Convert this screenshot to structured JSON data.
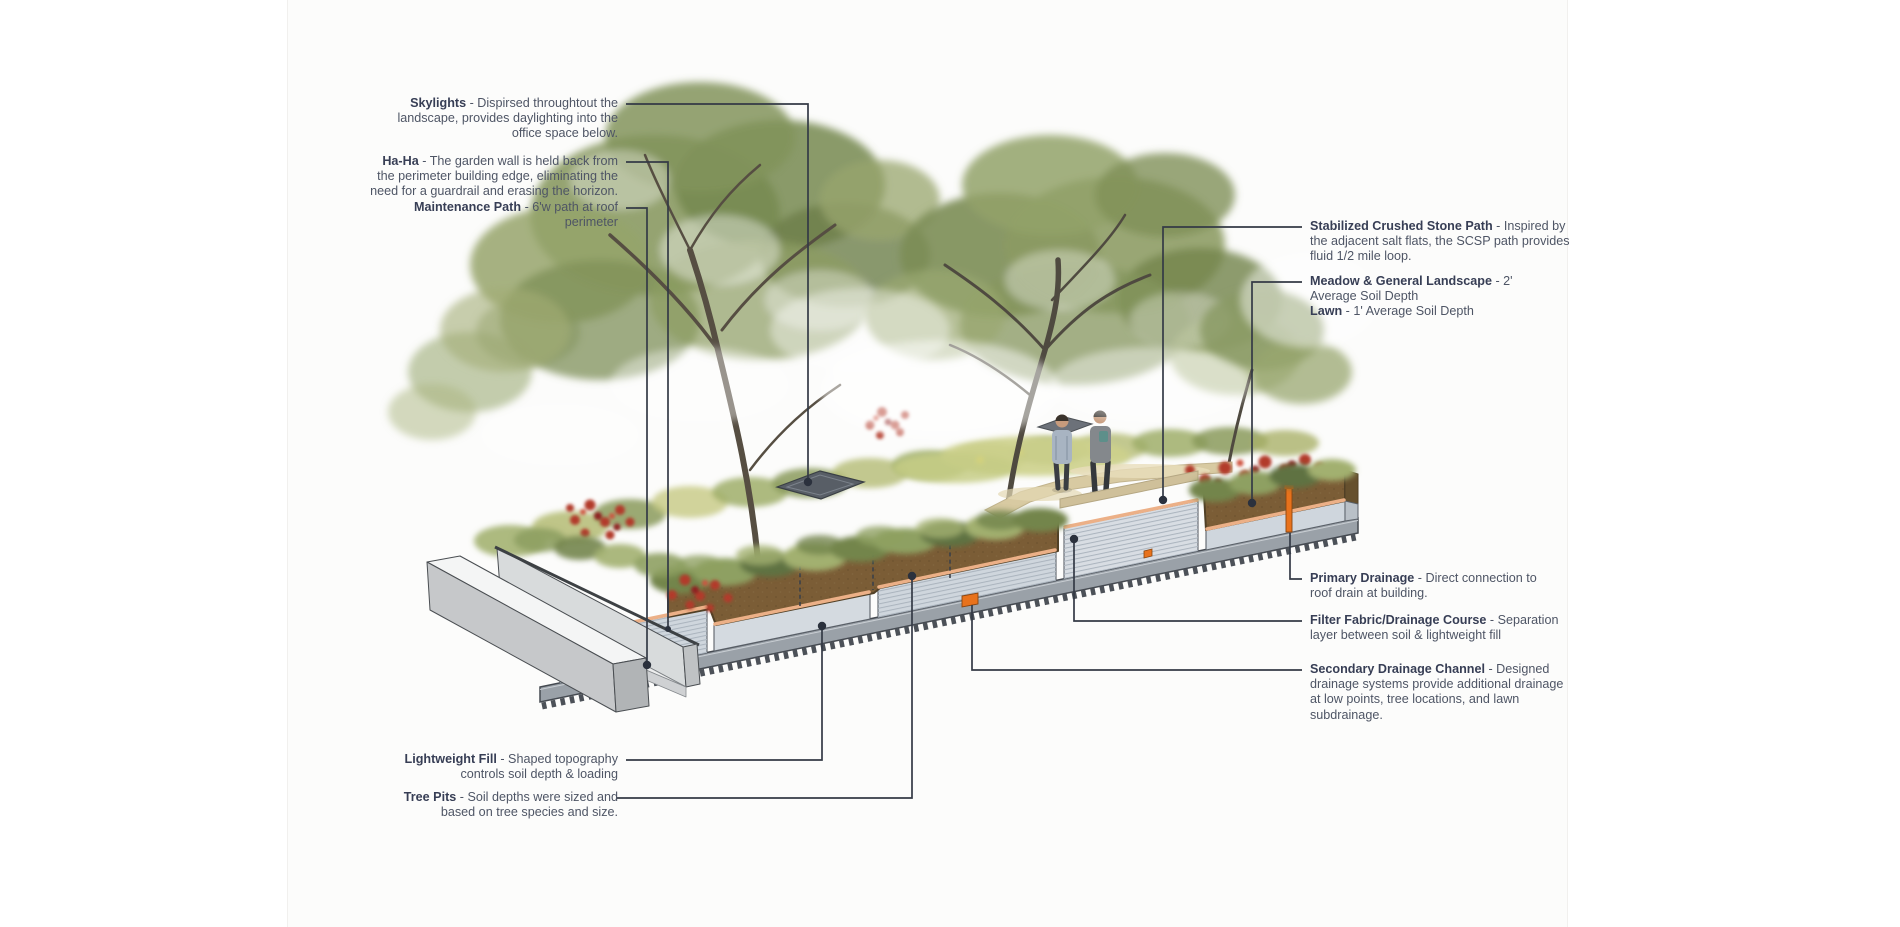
{
  "figure": {
    "type": "green-roof-section-diagram",
    "background": "#ffffff",
    "panel_background": "#fcfcfb"
  },
  "annotations": {
    "left": [
      {
        "term": "Skylights",
        "text": " - Dispirsed throughtout the landscape, provides daylighting into the office space below."
      },
      {
        "term": "Ha-Ha",
        "text": " - The garden wall is held back from the perimeter building edge, eliminating the need for a guardrail and erasing the horizon."
      },
      {
        "term": "Maintenance Path",
        "text": " - 6'w path at roof perimeter"
      },
      {
        "term": "Lightweight Fill",
        "text": " - Shaped topography controls soil depth & loading"
      },
      {
        "term": "Tree Pits",
        "text": " - Soil depths were sized and based on tree species and size."
      }
    ],
    "right": [
      {
        "term": "Stabilized Crushed Stone Path",
        "text": "  - Inspired by the adjacent salt flats, the SCSP path provides fluid 1/2 mile loop."
      },
      {
        "term": "Meadow & General Landscape",
        "text": " - 2' Average Soil Depth",
        "term2": "Lawn",
        "text2": " - 1' Average Soil Depth"
      },
      {
        "term": "Primary Drainage",
        "text": " - Direct connection to roof drain at building."
      },
      {
        "term": "Filter Fabric/Drainage Course",
        "text": " - Separation layer between soil & lightweight fill"
      },
      {
        "term": "Secondary Drainage Channel",
        "text": " - Designed drainage systems provide additional drainage at low points, tree locations, and lawn subdrainage."
      }
    ]
  },
  "colors": {
    "label_term": "#373e55",
    "label_text": "#4e5565",
    "leader_line": "#343a46",
    "soil_brown": "#7b5d36",
    "lightweight_fill": "#cfd6dd",
    "filter_fabric": "#ecb087",
    "roof_deck": "#9aa1a8",
    "drainage_orange": "#e8721c",
    "foliage_green": "#8a9a62",
    "red_shrub": "#b23a2c",
    "stone_path": "#d8caa2",
    "wall_gray": "#d8dbdc"
  }
}
